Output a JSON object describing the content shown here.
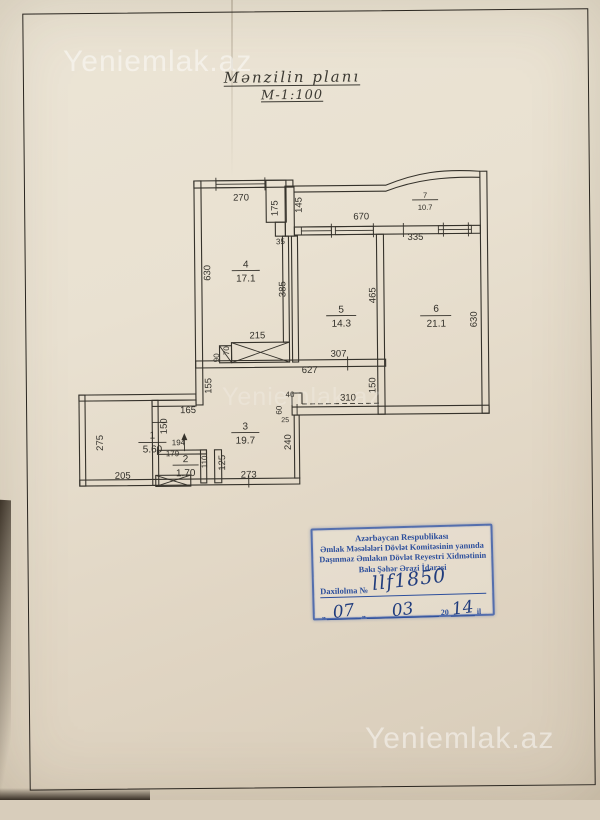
{
  "watermark": "Yeniemlak.az",
  "title": {
    "line1": "Mənzilin planı",
    "line2": "M-1:100"
  },
  "plan": {
    "rooms": [
      {
        "num": "1",
        "area": "5.60"
      },
      {
        "num": "2",
        "area": "1.70"
      },
      {
        "num": "3",
        "area": "19.7"
      },
      {
        "num": "4",
        "area": "17.1"
      },
      {
        "num": "5",
        "area": "14.3"
      },
      {
        "num": "6",
        "area": "21.1"
      },
      {
        "num": "7",
        "area": "10.7"
      }
    ],
    "dims": [
      "270",
      "175",
      "145",
      "670",
      "35",
      "335",
      "630",
      "385",
      "465",
      "630",
      "215",
      "70",
      "90",
      "307",
      "627",
      "155",
      "150",
      "40",
      "310",
      "60",
      "25",
      "165",
      "150",
      "275",
      "194",
      "179",
      "110",
      "125",
      "205",
      "273",
      "240"
    ]
  },
  "stamp": {
    "line1": "Azərbaycan Respublikası",
    "line2": "Əmlak Məsələləri Dövlət Komitəsinin yanında",
    "line3": "Daşınmaz Əmlakın Dövlət Reyestri Xidmətinin",
    "line4": "Bakı Şəhər Ərazi İdarəsi",
    "field_label": "Daxilolma №",
    "number": "llf1850",
    "quote": "„",
    "day": "07",
    "month": "03",
    "century": "20",
    "year": "14",
    "year_suffix": "il"
  }
}
